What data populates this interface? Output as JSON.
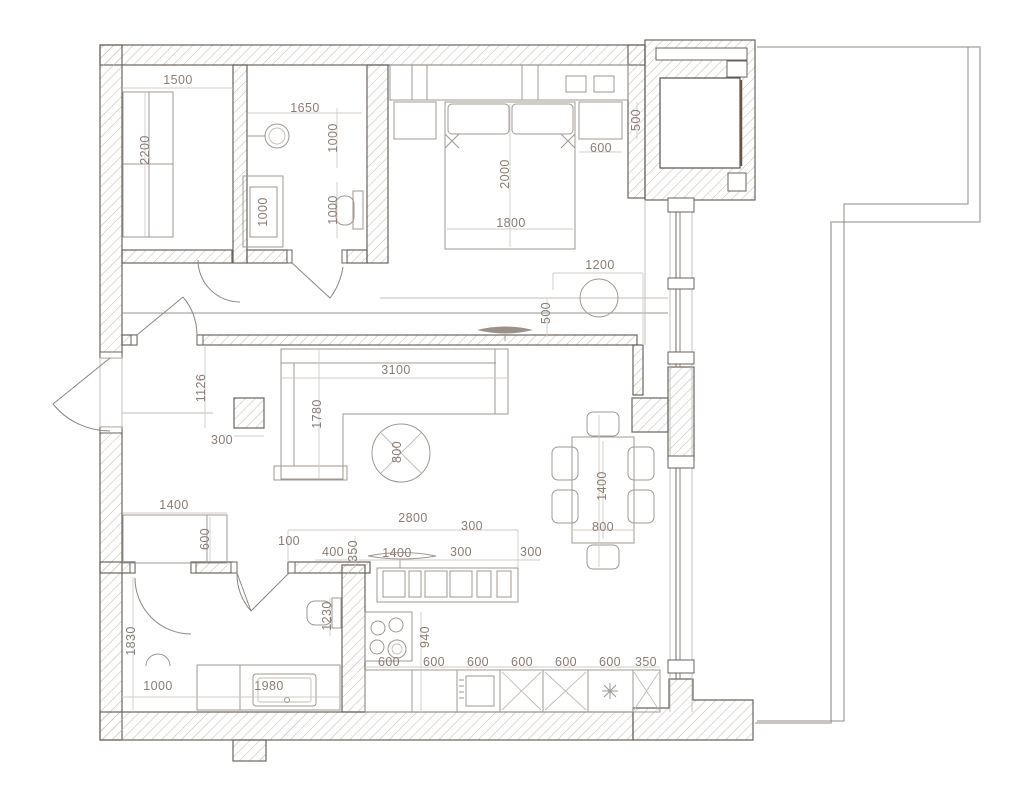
{
  "plan": {
    "type": "apartment-floor-plan",
    "units": "mm"
  },
  "colors": {
    "wall_line": "#6b635d",
    "hatch": "#c6bdb4",
    "furniture_line": "#a09890",
    "dim_line": "#d2cbc4",
    "dim_text": "#8d7c72",
    "glazing_accent": "#6b5348",
    "balcony_line": "#b6b0aa"
  },
  "dims": {
    "wardrobe": {
      "width": "1500",
      "depth": "2200"
    },
    "bath1": {
      "width": "1650",
      "niche": "1000",
      "washer": "1000",
      "wc": "1000"
    },
    "bedroom": {
      "bed_length": "2000",
      "bed_width": "1800",
      "nightstand": "600",
      "nightstand_depth": "500",
      "ottoman": "1200"
    },
    "living": {
      "sofa_length": "3100",
      "sofa_depth": "1780",
      "coffee_table": "800",
      "tv_gap": "500"
    },
    "hall": {
      "width": "1126",
      "column": "300",
      "closet_width": "1400",
      "closet_depth": "600"
    },
    "dining": {
      "table_length": "1400",
      "table_width": "800"
    },
    "kitchen": {
      "run": "2800",
      "offset": "100",
      "d400": "400",
      "d350": "350",
      "island": "1400",
      "d300_top": "300",
      "d300_left": "300",
      "d300_right": "300",
      "depth": "940",
      "cab1": "600",
      "cab2": "600",
      "cab3": "600",
      "cab4": "600",
      "cab5": "600",
      "cab6": "600",
      "end": "350"
    },
    "bath2": {
      "depth": "1830",
      "wc": "1230",
      "shower": "1000",
      "vanity": "1980"
    }
  }
}
